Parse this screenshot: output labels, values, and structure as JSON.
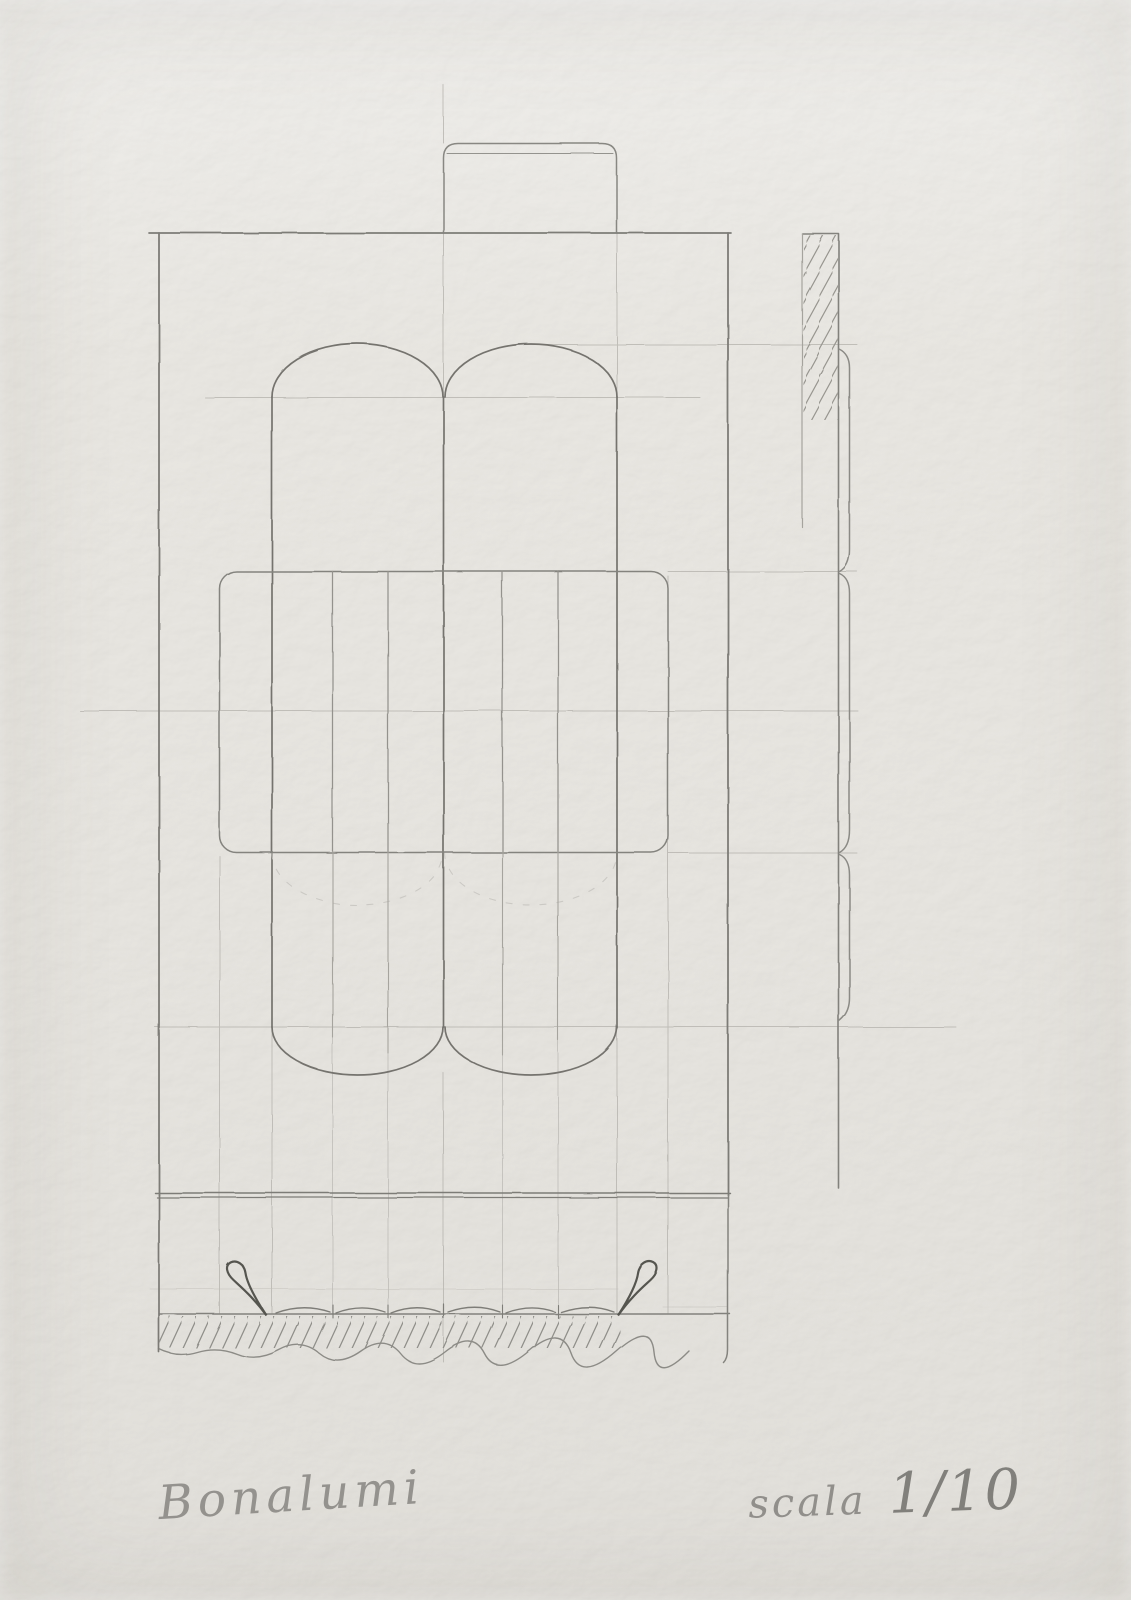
{
  "artwork": {
    "signature": "Bonalumi",
    "scale": {
      "label": "scala",
      "value": "1/10"
    }
  },
  "colors": {
    "paper": "#e9e7e2",
    "pencil_dark": "#55544f",
    "pencil_medium": "#82817c",
    "pencil_faint": "#b7b5b0"
  }
}
